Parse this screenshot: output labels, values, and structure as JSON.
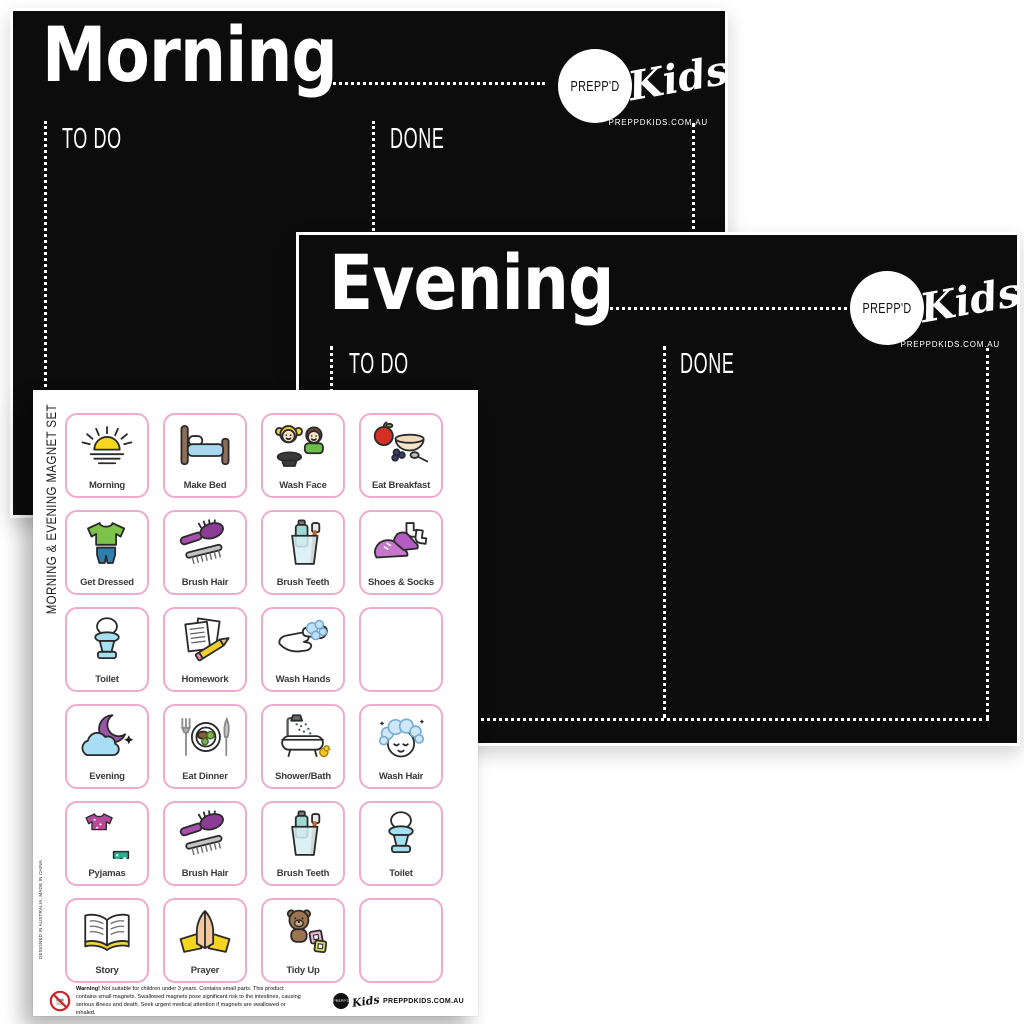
{
  "background_color": "#ffffff",
  "board_color": "#0c0c0c",
  "accent_pink": "#efaacd",
  "morning_board": {
    "title": "Morning",
    "todo_label": "TO DO",
    "done_label": "DONE",
    "logo": {
      "circle_text": "PREPP'D",
      "script_text": "Kids",
      "website": "PREPPDKIDS.COM.AU"
    }
  },
  "evening_board": {
    "title": "Evening",
    "todo_label": "TO DO",
    "done_label": "DONE",
    "logo": {
      "circle_text": "PREPP'D",
      "script_text": "Kids",
      "website": "PREPPDKIDS.COM.AU"
    }
  },
  "magnet_sheet": {
    "side_title": "MORNING & EVENING MAGNET SET",
    "side_note": "DESIGNED IN AUSTRALIA. MADE IN CHINA",
    "cells": [
      {
        "label": "Morning",
        "icon": "sunrise"
      },
      {
        "label": "Make Bed",
        "icon": "bed"
      },
      {
        "label": "Wash Face",
        "icon": "wash-face"
      },
      {
        "label": "Eat Breakfast",
        "icon": "breakfast"
      },
      {
        "label": "Get Dressed",
        "icon": "clothes"
      },
      {
        "label": "Brush Hair",
        "icon": "hairbrush"
      },
      {
        "label": "Brush Teeth",
        "icon": "toothbrush"
      },
      {
        "label": "Shoes & Socks",
        "icon": "shoes-socks"
      },
      {
        "label": "Toilet",
        "icon": "toilet"
      },
      {
        "label": "Homework",
        "icon": "homework"
      },
      {
        "label": "Wash Hands",
        "icon": "wash-hands"
      },
      {
        "label": "",
        "icon": ""
      },
      {
        "label": "Evening",
        "icon": "moon-cloud"
      },
      {
        "label": "Eat Dinner",
        "icon": "dinner"
      },
      {
        "label": "Shower/Bath",
        "icon": "bath"
      },
      {
        "label": "Wash Hair",
        "icon": "wash-hair"
      },
      {
        "label": "Pyjamas",
        "icon": "pyjamas"
      },
      {
        "label": "Brush Hair",
        "icon": "hairbrush"
      },
      {
        "label": "Brush Teeth",
        "icon": "toothbrush"
      },
      {
        "label": "Toilet",
        "icon": "toilet"
      },
      {
        "label": "Story",
        "icon": "book"
      },
      {
        "label": "Prayer",
        "icon": "prayer"
      },
      {
        "label": "Tidy Up",
        "icon": "tidy-up"
      },
      {
        "label": "",
        "icon": ""
      }
    ],
    "warning": {
      "bold": "Warning!",
      "text": " Not suitable for children under 3 years. Contains small parts. This product contains small magnets. Swallowed magnets pose significant risk to the intestines, causing serious illness and death. Seek urgent medical attention if magnets are swallowed or inhaled."
    },
    "footer_logo": {
      "circle_text": "PREPP'D",
      "script_text": "Kids",
      "website": "PREPPDKIDS.COM.AU"
    }
  }
}
